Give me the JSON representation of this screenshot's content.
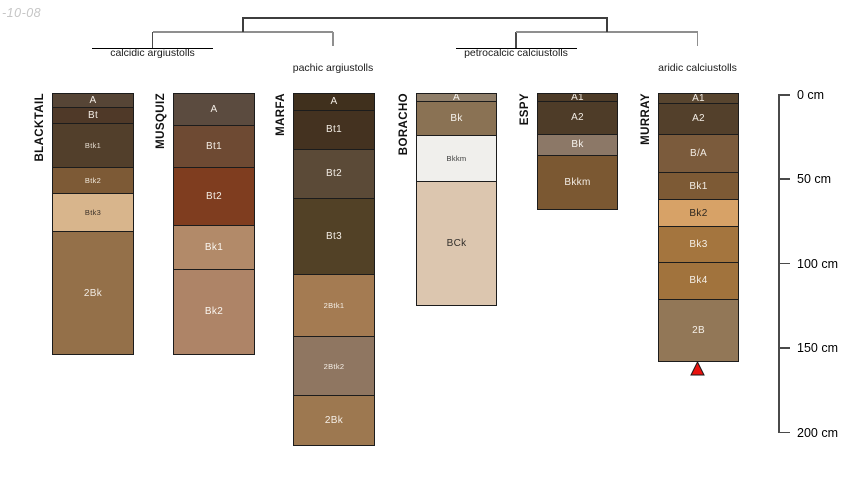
{
  "watermark": "-10-08",
  "figure": {
    "type": "soil-profile-dendrogram",
    "depth_unit": "cm"
  },
  "dendrogram": {
    "clusters": [
      {
        "id": "calcidic",
        "label": "calcidic argiustolls",
        "members": [
          "BLACKTAIL",
          "MUSQUIZ"
        ],
        "leaf_line": true,
        "label_top": 47
      },
      {
        "id": "pachic",
        "label": "pachic argiustolls",
        "members": [
          "MARFA"
        ],
        "leaf_line": false,
        "label_top": 61.5
      },
      {
        "id": "petrocalcic",
        "label": "petrocalcic calciustolls",
        "members": [
          "BORACHO",
          "ESPY"
        ],
        "leaf_line": true,
        "label_top": 46.5
      },
      {
        "id": "aridic",
        "label": "aridic calciustolls",
        "members": [
          "MURRAY"
        ],
        "leaf_line": false,
        "label_top": 62
      }
    ],
    "pairs": [
      [
        "calcidic",
        "pachic"
      ],
      [
        "petrocalcic",
        "aridic"
      ]
    ]
  },
  "depth_scale": {
    "unit": "cm",
    "ticks": [
      {
        "cm": 0,
        "label": "0 cm"
      },
      {
        "cm": 50,
        "label": "50 cm"
      },
      {
        "cm": 100,
        "label": "100 cm"
      },
      {
        "cm": 150,
        "label": "150 cm"
      },
      {
        "cm": 200,
        "label": "200 cm"
      }
    ]
  },
  "profiles": [
    {
      "name": "BLACKTAIL",
      "group": "calcidic argiustolls",
      "x": 52,
      "width": 80,
      "horizons": [
        {
          "name": "A",
          "top_cm": 0,
          "bottom_cm": 8,
          "color": "#564536",
          "text_color": "#f2ece4"
        },
        {
          "name": "Bt",
          "top_cm": 8,
          "bottom_cm": 18,
          "color": "#4f3928",
          "text_color": "#f2ece4"
        },
        {
          "name": "Btk1",
          "top_cm": 18,
          "bottom_cm": 44,
          "color": "#523f2b",
          "text_color": "#e6ddd1",
          "small": true
        },
        {
          "name": "Btk2",
          "top_cm": 44,
          "bottom_cm": 59,
          "color": "#7d5a36",
          "text_color": "#f0e7da",
          "small": true
        },
        {
          "name": "Btk3",
          "top_cm": 59,
          "bottom_cm": 82,
          "color": "#d8b58c",
          "text_color": "#3a3028",
          "small": true
        },
        {
          "name": "2Bk",
          "top_cm": 82,
          "bottom_cm": 154,
          "color": "#947049",
          "text_color": "#f2ece4"
        }
      ]
    },
    {
      "name": "MUSQUIZ",
      "group": "calcidic argiustolls",
      "x": 173,
      "width": 80,
      "horizons": [
        {
          "name": "A",
          "top_cm": 0,
          "bottom_cm": 19,
          "color": "#5b4b3f",
          "text_color": "#f2ece4"
        },
        {
          "name": "Bt1",
          "top_cm": 19,
          "bottom_cm": 44,
          "color": "#6e4a33",
          "text_color": "#f2ece4"
        },
        {
          "name": "Bt2",
          "top_cm": 44,
          "bottom_cm": 78,
          "color": "#7f3d1f",
          "text_color": "#f2ece4"
        },
        {
          "name": "Bk1",
          "top_cm": 78,
          "bottom_cm": 104,
          "color": "#b28a69",
          "text_color": "#faf6f0"
        },
        {
          "name": "Bk2",
          "top_cm": 104,
          "bottom_cm": 154,
          "color": "#ae8467",
          "text_color": "#faf6f0"
        }
      ]
    },
    {
      "name": "MARFA",
      "group": "pachic argiustolls",
      "x": 293,
      "width": 80,
      "horizons": [
        {
          "name": "A",
          "top_cm": 0,
          "bottom_cm": 10,
          "color": "#40301d",
          "text_color": "#f2ece4"
        },
        {
          "name": "Bt1",
          "top_cm": 10,
          "bottom_cm": 33,
          "color": "#443220",
          "text_color": "#f2ece4"
        },
        {
          "name": "Bt2",
          "top_cm": 33,
          "bottom_cm": 62,
          "color": "#5b4a37",
          "text_color": "#f2ece4"
        },
        {
          "name": "Bt3",
          "top_cm": 62,
          "bottom_cm": 107,
          "color": "#524126",
          "text_color": "#f2ece4"
        },
        {
          "name": "2Btk1",
          "top_cm": 107,
          "bottom_cm": 144,
          "color": "#a47b52",
          "text_color": "#f5efe7",
          "small": true
        },
        {
          "name": "2Btk2",
          "top_cm": 144,
          "bottom_cm": 179,
          "color": "#8f7661",
          "text_color": "#f5efe7",
          "small": true
        },
        {
          "name": "2Bk",
          "top_cm": 179,
          "bottom_cm": 208,
          "color": "#9d7850",
          "text_color": "#f5efe7"
        }
      ]
    },
    {
      "name": "BORACHO",
      "group": "petrocalcic calciustolls",
      "x": 416,
      "width": 79,
      "horizons": [
        {
          "name": "A",
          "top_cm": 0,
          "bottom_cm": 5,
          "color": "#8f7e69",
          "text_color": "#f7f4ef"
        },
        {
          "name": "Bk",
          "top_cm": 5,
          "bottom_cm": 25,
          "color": "#8a7254",
          "text_color": "#f7f4ef"
        },
        {
          "name": "Bkkm",
          "top_cm": 25,
          "bottom_cm": 52,
          "color": "#f0efec",
          "text_color": "#3a3a3a",
          "small": true
        },
        {
          "name": "BCk",
          "top_cm": 52,
          "bottom_cm": 125,
          "color": "#dcc6af",
          "text_color": "#33302c"
        }
      ]
    },
    {
      "name": "ESPY",
      "group": "petrocalcic calciustolls",
      "x": 537,
      "width": 79,
      "horizons": [
        {
          "name": "A1",
          "top_cm": 0,
          "bottom_cm": 5,
          "color": "#4d3b27",
          "text_color": "#f2ece4"
        },
        {
          "name": "A2",
          "top_cm": 5,
          "bottom_cm": 24,
          "color": "#4e3c28",
          "text_color": "#f2ece4"
        },
        {
          "name": "Bk",
          "top_cm": 24,
          "bottom_cm": 37,
          "color": "#8c7867",
          "text_color": "#f7f4ef"
        },
        {
          "name": "Bkkm",
          "top_cm": 37,
          "bottom_cm": 68,
          "color": "#7b5832",
          "text_color": "#f2ece4"
        }
      ]
    },
    {
      "name": "MURRAY",
      "group": "aridic calciustolls",
      "x": 658,
      "width": 79,
      "horizons": [
        {
          "name": "A1",
          "top_cm": 0,
          "bottom_cm": 6,
          "color": "#58452f",
          "text_color": "#f2ece4"
        },
        {
          "name": "A2",
          "top_cm": 6,
          "bottom_cm": 24,
          "color": "#53402b",
          "text_color": "#f2ece4"
        },
        {
          "name": "B/A",
          "top_cm": 24,
          "bottom_cm": 47,
          "color": "#7b5b3c",
          "text_color": "#f2ece4"
        },
        {
          "name": "Bk1",
          "top_cm": 47,
          "bottom_cm": 63,
          "color": "#7d5a35",
          "text_color": "#f2ece4"
        },
        {
          "name": "Bk2",
          "top_cm": 63,
          "bottom_cm": 79,
          "color": "#d7a267",
          "text_color": "#2e2820"
        },
        {
          "name": "Bk3",
          "top_cm": 79,
          "bottom_cm": 100,
          "color": "#a4753e",
          "text_color": "#f5efe7"
        },
        {
          "name": "Bk4",
          "top_cm": 100,
          "bottom_cm": 122,
          "color": "#a1733d",
          "text_color": "#f5efe7"
        },
        {
          "name": "2B",
          "top_cm": 122,
          "bottom_cm": 158,
          "color": "#927757",
          "text_color": "#f5efe7"
        }
      ],
      "marker": {
        "symbol": "triangle-up",
        "color": "#e8120e",
        "outline": "#1a1a1a"
      }
    }
  ]
}
